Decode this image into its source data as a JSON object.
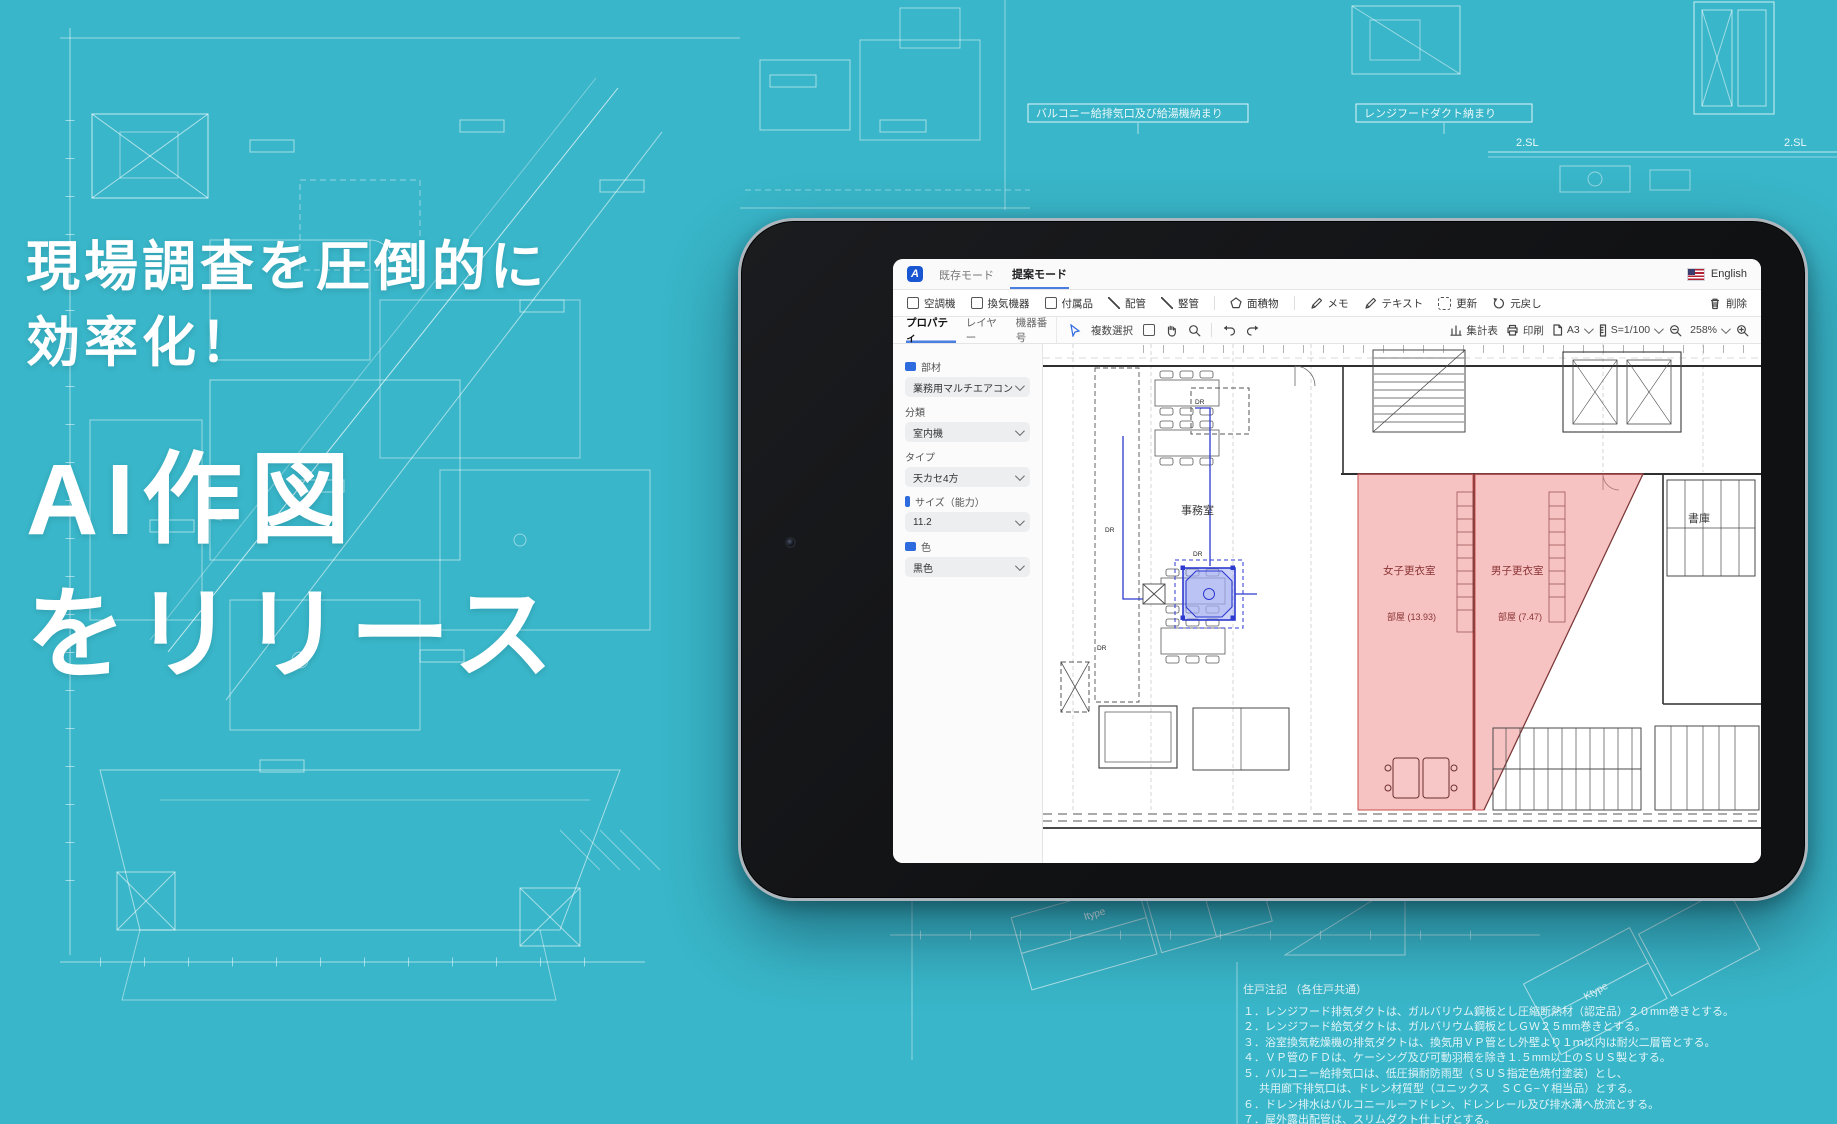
{
  "hero": {
    "lines": [
      "現場調査を圧倒的に",
      "効率化！",
      "AI作図",
      "をリリース"
    ]
  },
  "app": {
    "navbar": {
      "logo_text": "A",
      "tabs": [
        {
          "label": "既存モード"
        },
        {
          "label": "提案モード"
        }
      ],
      "active_tab": "提案モード",
      "language_label": "English"
    },
    "toolbar": {
      "items": [
        {
          "label": "空調機",
          "icon": "checkbox"
        },
        {
          "label": "換気機器",
          "icon": "checkbox"
        },
        {
          "label": "付属品",
          "icon": "checkbox"
        },
        {
          "label": "配管",
          "icon": "diagonal-line"
        },
        {
          "label": "竪管",
          "icon": "diagonal-line"
        },
        {
          "label": "面積物",
          "icon": "pentagon"
        },
        {
          "label": "メモ",
          "icon": "pencil"
        },
        {
          "label": "テキスト",
          "icon": "pencil"
        },
        {
          "label": "更新",
          "icon": "dashed-square"
        },
        {
          "label": "元戻し",
          "icon": "undo-arrow"
        }
      ],
      "delete_label": "削除"
    },
    "subbar": {
      "panel_tabs": [
        "プロパティ",
        "レイヤー",
        "機器番号"
      ],
      "active_panel_tab": "プロパティ",
      "multi_select_label": "複数選択",
      "right": {
        "summary": "集計表",
        "print": "印刷",
        "paper": "A3",
        "scale": "S=1/100",
        "zoom": "258%"
      }
    },
    "properties": {
      "fields": [
        {
          "label": "部材",
          "value": "業務用マルチエアコン",
          "has_icon": true
        },
        {
          "label": "分類",
          "value": "室内機",
          "has_icon": false
        },
        {
          "label": "タイプ",
          "value": "天カセ4方",
          "has_icon": false
        },
        {
          "label": "サイズ（能力）",
          "value": "11.2",
          "has_icon": true
        },
        {
          "label": "色",
          "value": "黒色",
          "has_icon": true
        }
      ]
    },
    "canvas": {
      "room_office": "事務室",
      "room_women": "女子更衣室",
      "room_women_area": "部屋 (13.93)",
      "room_men": "男子更衣室",
      "room_men_area": "部屋 (7.47)",
      "room_storage": "書庫",
      "marks": [
        "DR",
        "DR",
        "DR",
        "DR"
      ]
    }
  },
  "background": {
    "callout1": "バルコニー給排気口及び給湯機納まり",
    "callout2": "レンジフードダクト納まり",
    "level_mark1": "2.SL",
    "level_mark2": "2.SL",
    "unit_types": [
      "Jtype",
      "Itype",
      "Ktype"
    ],
    "notes_title": "住戸注記 （各住戸共通）",
    "notes": [
      "１．レンジフード排気ダクトは、ガルバリウム鋼板とし圧縮断熱材（認定品）２０mm巻きとする。",
      "２．レンジフード給気ダクトは、ガルバリウム鋼板としＧＷ２５mm巻きとする。",
      "３．浴室換気乾燥機の排気ダクトは、換気用ＶＰ管とし外壁より１ｍ以内は耐火二層管とする。",
      "４．ＶＰ管のＦＤは、ケーシング及び可動羽根を除き１.５mm以上のＳＵＳ製とする。",
      "５．バルコニー給排気口は、低圧損耐防雨型（ＳＵＳ指定色焼付塗装）とし、",
      "共用廊下排気口は、ドレン材質型（ユニックス　ＳＣＧ−Ｙ相当品）とする。",
      "６．ドレン排水はバルコニールーフドレン、ドレンレール及び排水溝へ放流とする。",
      "７．屋外露出配管は、スリムダクト仕上げとする。",
      "８．オプションエアコンの先行冷媒管は、予定室外機設置位置まで配管する（樹脂カバー設置）",
      "ドレン管も排水溝まで先行配管とする。"
    ]
  },
  "icons": [
    "app-logo",
    "us-flag",
    "checkbox",
    "diagonal-line",
    "pentagon",
    "pencil",
    "dashed-square",
    "undo-arrow",
    "trash",
    "cursor-arrow",
    "hand",
    "magnifier",
    "undo",
    "redo",
    "summary-chart",
    "printer",
    "page",
    "ruler",
    "zoom-out",
    "zoom-in",
    "chevron-down"
  ],
  "colors": {
    "background_teal": "#39b6c9",
    "accent_blue": "#2e6bdf",
    "tab_underline": "#4a7fe0",
    "selection_blue": "#2d3ad0",
    "highlight_pink": "#ef8585",
    "highlight_pink_border": "#c94f4f"
  }
}
